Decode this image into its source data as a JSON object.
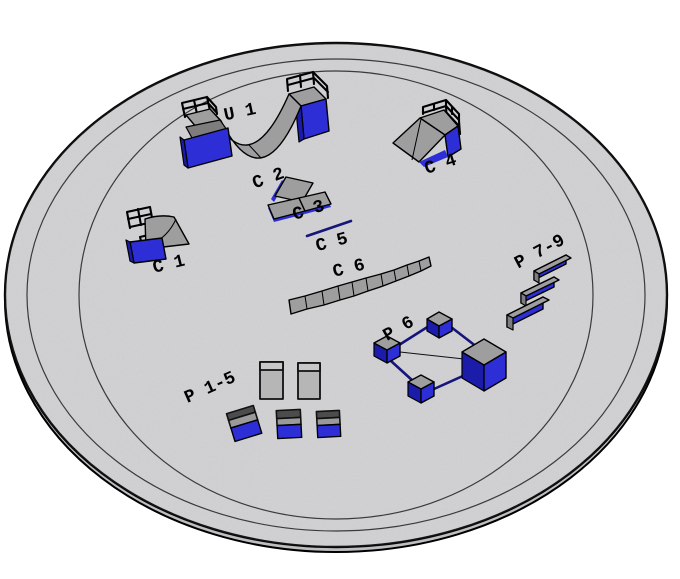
{
  "scene": {
    "background_color": "#ffffff",
    "pad": {
      "fill": "#d3d3d5",
      "edge_color": "#000000",
      "ring_color": "#3a3a3a",
      "slab_side_color": "#bfbfc2"
    },
    "palette": {
      "obstacle_gray": "#9e9e9e",
      "obstacle_gray_light": "#b6b6b6",
      "obstacle_gray_dark": "#7d7d7d",
      "blue_bright": "#2e2ed6",
      "blue_dark": "#1c1caa",
      "rail_blue": "#15157a",
      "outline": "#000000",
      "label_color": "#000000"
    }
  },
  "labels": {
    "u1": "U 1",
    "c1": "C 1",
    "c2": "C 2",
    "c3": "C 3",
    "c4": "C 4",
    "c5": "C 5",
    "c6": "C 6",
    "p1_5": "P 1-5",
    "p6": "P 6",
    "p7_9": "P 7-9"
  }
}
